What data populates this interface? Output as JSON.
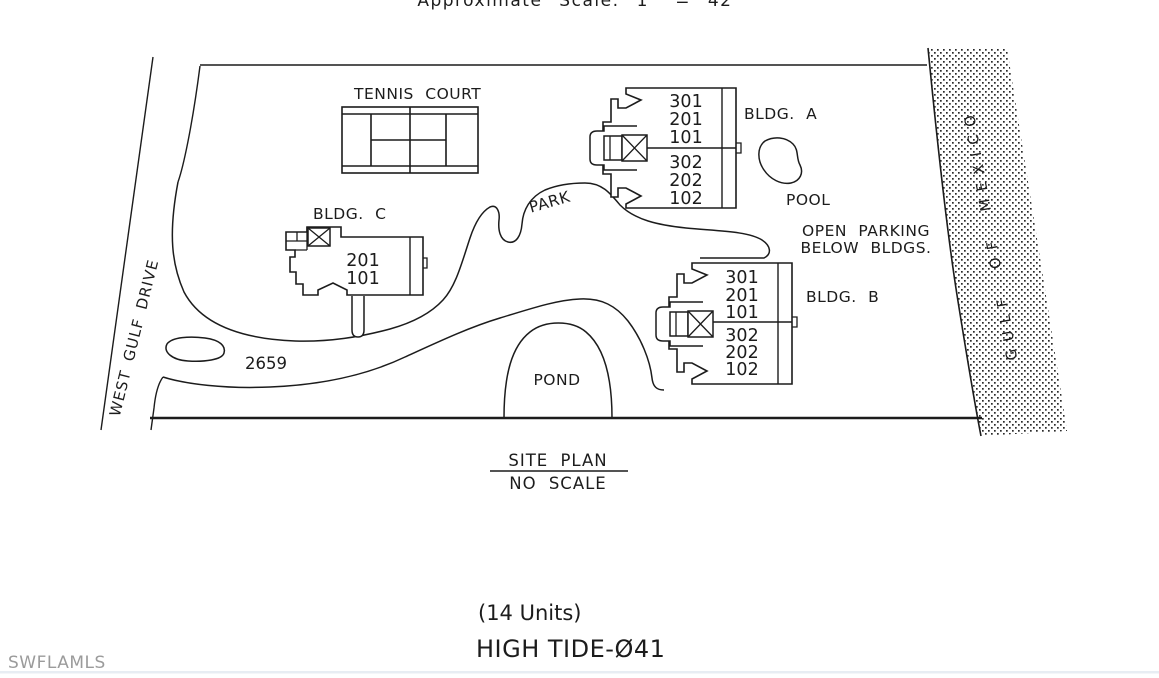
{
  "top_note": {
    "text": "Approximate  Scale:  1\" = 42'"
  },
  "site_plan": {
    "street_label": "WEST GULF DRIVE",
    "gulf_label": "GULF OF MEXICO",
    "address_number": "2659",
    "tennis_court_label": "TENNIS COURT",
    "park_label": "PARK",
    "pool_label": "POOL",
    "pond_label": "POND",
    "open_parking_note_line1": "OPEN PARKING",
    "open_parking_note_line2": "BELOW BLDGS.",
    "buildings": {
      "a": {
        "label": "BLDG. A",
        "gulf_side_units": [
          "301",
          "201",
          "101"
        ],
        "street_side_units": [
          "302",
          "202",
          "102"
        ]
      },
      "b": {
        "label": "BLDG. B",
        "gulf_side_units": [
          "301",
          "201",
          "101"
        ],
        "street_side_units": [
          "302",
          "202",
          "102"
        ]
      },
      "c": {
        "label": "BLDG. C",
        "units": [
          "201",
          "101"
        ]
      }
    }
  },
  "title_block": {
    "title": "SITE PLAN",
    "scale": "NO SCALE"
  },
  "summary": {
    "unit_count": "(14 Units)",
    "property_name": "HIGH TIDE-Ø41"
  },
  "watermark": {
    "text": "SWFLAMLS"
  },
  "colors": {
    "ink": "#1c1c1c",
    "watermark_gray": "#9b9b9b",
    "footer_strip": "#e8edf3",
    "background": "#ffffff"
  }
}
